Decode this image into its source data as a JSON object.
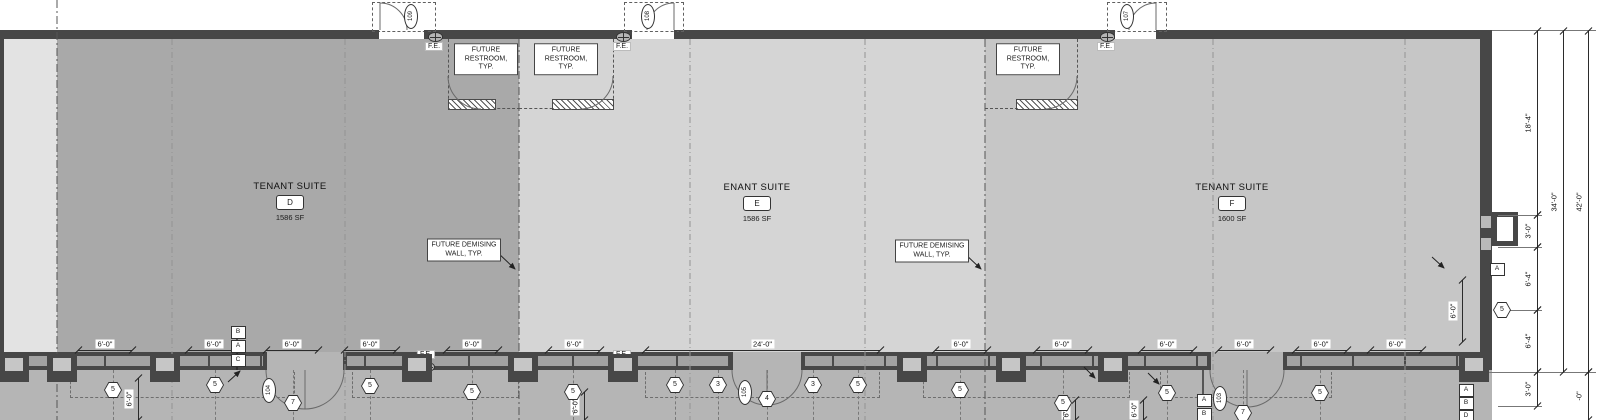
{
  "drawing": {
    "colors": {
      "suite_d": "#a9a9a9",
      "suite_e": "#d5d5d5",
      "suite_f": "#c6c6c6",
      "adjacent_suite": "#e3e3e3",
      "wall": "#474747",
      "exterior_band": "#b5b5b5",
      "line": "#333333"
    },
    "suites": [
      {
        "name": "TENANT SUITE",
        "letter": "D",
        "area": "1586 SF"
      },
      {
        "name": "ENANT SUITE",
        "letter": "E",
        "area": "1586 SF"
      },
      {
        "name": "TENANT SUITE",
        "letter": "F",
        "area": "1600 SF"
      }
    ],
    "labels": {
      "restroom_note": "FUTURE\nRESTROOM,\nTYP.",
      "demising_note": "FUTURE DEMISING\nWALL, TYP.",
      "fire_extinguisher": "F.E."
    },
    "dimensions_horizontal": [
      {
        "x1": 78,
        "x2": 132,
        "label": "6'-0\""
      },
      {
        "x1": 188,
        "x2": 240,
        "label": "6'-0\""
      },
      {
        "x1": 266,
        "x2": 318,
        "label": "6'-0\""
      },
      {
        "x1": 344,
        "x2": 396,
        "label": "6'-0\""
      },
      {
        "x1": 446,
        "x2": 498,
        "label": "6'-0\""
      },
      {
        "x1": 548,
        "x2": 600,
        "label": "6'-0\""
      },
      {
        "x1": 645,
        "x2": 880,
        "label": "24'-0\""
      },
      {
        "x1": 935,
        "x2": 987,
        "label": "6'-0\""
      },
      {
        "x1": 1036,
        "x2": 1088,
        "label": "6'-0\""
      },
      {
        "x1": 1141,
        "x2": 1193,
        "label": "6'-0\""
      },
      {
        "x1": 1218,
        "x2": 1270,
        "label": "6'-0\""
      },
      {
        "x1": 1295,
        "x2": 1347,
        "label": "6'-0\""
      },
      {
        "x1": 1370,
        "x2": 1422,
        "label": "6'-0\""
      }
    ],
    "dimensions_vertical": [
      {
        "x": 1537,
        "y1": 31,
        "y2": 215,
        "label": "18'-4\""
      },
      {
        "x": 1537,
        "y1": 215,
        "y2": 247,
        "label": "3'-0\""
      },
      {
        "x": 1537,
        "y1": 247,
        "y2": 310,
        "label": "6'-4\""
      },
      {
        "x": 1537,
        "y1": 310,
        "y2": 372,
        "label": "6'-4\""
      },
      {
        "x": 1537,
        "y1": 372,
        "y2": 406,
        "label": "3'-0\""
      },
      {
        "x": 1563,
        "y1": 31,
        "y2": 372,
        "label": "34'-0\""
      },
      {
        "x": 1588,
        "y1": 31,
        "y2": 372,
        "label": "42'-0\""
      },
      {
        "x": 1588,
        "y1": 372,
        "y2": 420,
        "label": "-0\""
      },
      {
        "x": 1462,
        "y1": 280,
        "y2": 342,
        "label": "6'-0\""
      },
      {
        "x": 138,
        "y1": 378,
        "y2": 420,
        "label": "6'-0\""
      },
      {
        "x": 584,
        "y1": 392,
        "y2": 420,
        "label": "6'-0\""
      },
      {
        "x": 1075,
        "y1": 400,
        "y2": 420,
        "label": "6'-0\""
      },
      {
        "x": 1143,
        "y1": 400,
        "y2": 420,
        "label": "6'-0\""
      }
    ],
    "hex_tags": [
      {
        "label": "5",
        "x": 113,
        "y": 390
      },
      {
        "label": "5",
        "x": 215,
        "y": 385
      },
      {
        "label": "7",
        "x": 293,
        "y": 403
      },
      {
        "label": "5",
        "x": 370,
        "y": 386
      },
      {
        "label": "5",
        "x": 472,
        "y": 392
      },
      {
        "label": "5",
        "x": 573,
        "y": 392
      },
      {
        "label": "5",
        "x": 675,
        "y": 385
      },
      {
        "label": "3",
        "x": 718,
        "y": 385
      },
      {
        "label": "4",
        "x": 767,
        "y": 399
      },
      {
        "label": "3",
        "x": 813,
        "y": 385
      },
      {
        "label": "5",
        "x": 858,
        "y": 385
      },
      {
        "label": "5",
        "x": 960,
        "y": 390
      },
      {
        "label": "5",
        "x": 1063,
        "y": 403
      },
      {
        "label": "5",
        "x": 1167,
        "y": 393
      },
      {
        "label": "7",
        "x": 1243,
        "y": 413
      },
      {
        "label": "5",
        "x": 1320,
        "y": 393
      },
      {
        "label": "5",
        "x": 1502,
        "y": 310
      }
    ],
    "square_tags": [
      {
        "label": "B",
        "x": 237,
        "y": 331
      },
      {
        "label": "A",
        "x": 237,
        "y": 345
      },
      {
        "label": "C",
        "x": 237,
        "y": 359
      },
      {
        "label": "A",
        "x": 1203,
        "y": 399
      },
      {
        "label": "B",
        "x": 1203,
        "y": 413
      },
      {
        "label": "A",
        "x": 1465,
        "y": 389
      },
      {
        "label": "B",
        "x": 1465,
        "y": 402
      },
      {
        "label": "D",
        "x": 1465,
        "y": 415
      },
      {
        "label": "A",
        "x": 1496,
        "y": 268
      }
    ],
    "door_tags": [
      {
        "label": "109",
        "x": 410,
        "y": 15
      },
      {
        "label": "108",
        "x": 647,
        "y": 15
      },
      {
        "label": "107",
        "x": 1126,
        "y": 15
      },
      {
        "label": "104",
        "x": 268,
        "y": 389
      },
      {
        "label": "105",
        "x": 744,
        "y": 391
      },
      {
        "label": "103",
        "x": 1219,
        "y": 397
      }
    ],
    "fe_markers": [
      {
        "x": 434,
        "y": 36,
        "text_pos": "below"
      },
      {
        "x": 622,
        "y": 36,
        "text_pos": "below"
      },
      {
        "x": 1106,
        "y": 36,
        "text_pos": "below"
      },
      {
        "x": 426,
        "y": 366,
        "text_pos": "above"
      },
      {
        "x": 622,
        "y": 366,
        "text_pos": "above"
      }
    ]
  }
}
